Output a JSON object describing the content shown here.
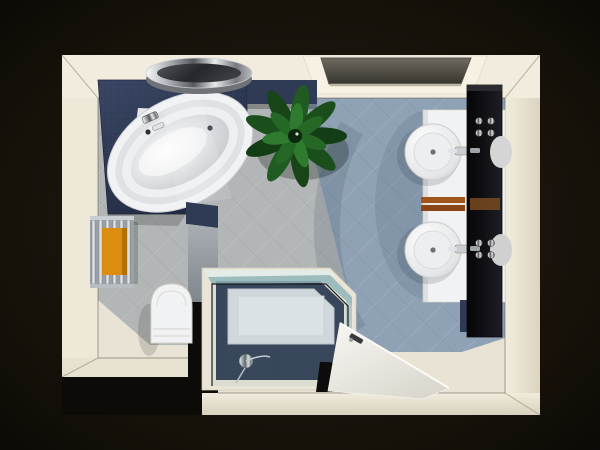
{
  "scene": {
    "title": "Bathroom 3D floor plan - top view render"
  },
  "palette": {
    "background": "#0e0b07",
    "wall": "#f2ecde",
    "floor": "#e8e3d4",
    "tile_gray": "#b3b6b6",
    "tile_blue": "#8fa1b5",
    "navy": "#2f3a54",
    "navy_dark": "#273148",
    "white_fixture": "#f1f2f3",
    "chrome": "#c9ced3",
    "plant_green": "#1c5320",
    "towel_orange": "#de8c0f",
    "towel_rust": "#a0551c",
    "mirror_black": "#0b0b0e",
    "glass_teal": "#8fb5b8",
    "door_white": "#f2f1ec",
    "skylight_gray": "#57544c"
  },
  "objects": {
    "bathtub": "corner-bathtub",
    "round_mirror": "round-chrome-mirror",
    "plant": "green-plant",
    "skylight": "recessed-ceiling-light",
    "vanity": "double-washbasin-counter",
    "mirror_panel": "black-mirror-panel",
    "vanity_towels": "hand-towel-bar",
    "towel_radiator": "towel-radiator-orange-towel",
    "toilet": "wall-hung-toilet",
    "shower": "corner-glass-shower",
    "door": "open-door"
  }
}
